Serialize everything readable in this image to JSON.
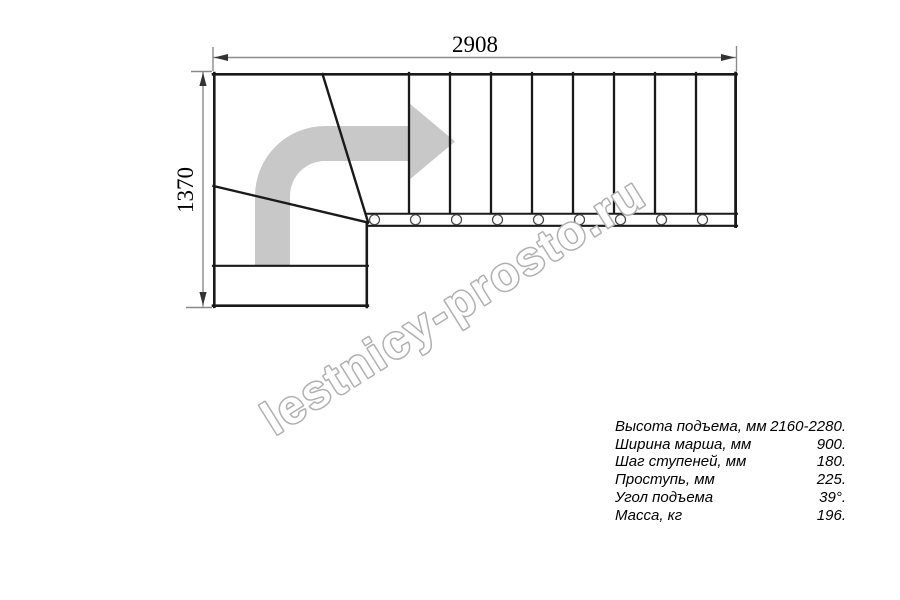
{
  "drawing": {
    "top_dimension": "2908",
    "left_dimension": "1370",
    "treads_straight_flight": 9,
    "baluster_count": 9,
    "direction_arrow_icon": "curved-right-arrow"
  },
  "watermark": "lestnicy-prosto.ru",
  "specs": {
    "rows": [
      {
        "label": "Высота подъема, мм",
        "value": "2160-2280."
      },
      {
        "label": "Ширина марша, мм",
        "value": "900."
      },
      {
        "label": "Шаг ступеней, мм",
        "value": "180."
      },
      {
        "label": "Проступь, мм",
        "value": "225."
      },
      {
        "label": "Угол подъема",
        "value": "39°."
      },
      {
        "label": "Масса, кг",
        "value": "196."
      }
    ]
  },
  "colors": {
    "structure_line": "#1a1a1a",
    "dimension_line": "#8a8a8a",
    "arrow_fill": "#c8c8c8",
    "watermark_outline": "#b0b0b0",
    "text": "#000000",
    "background": "#ffffff"
  }
}
